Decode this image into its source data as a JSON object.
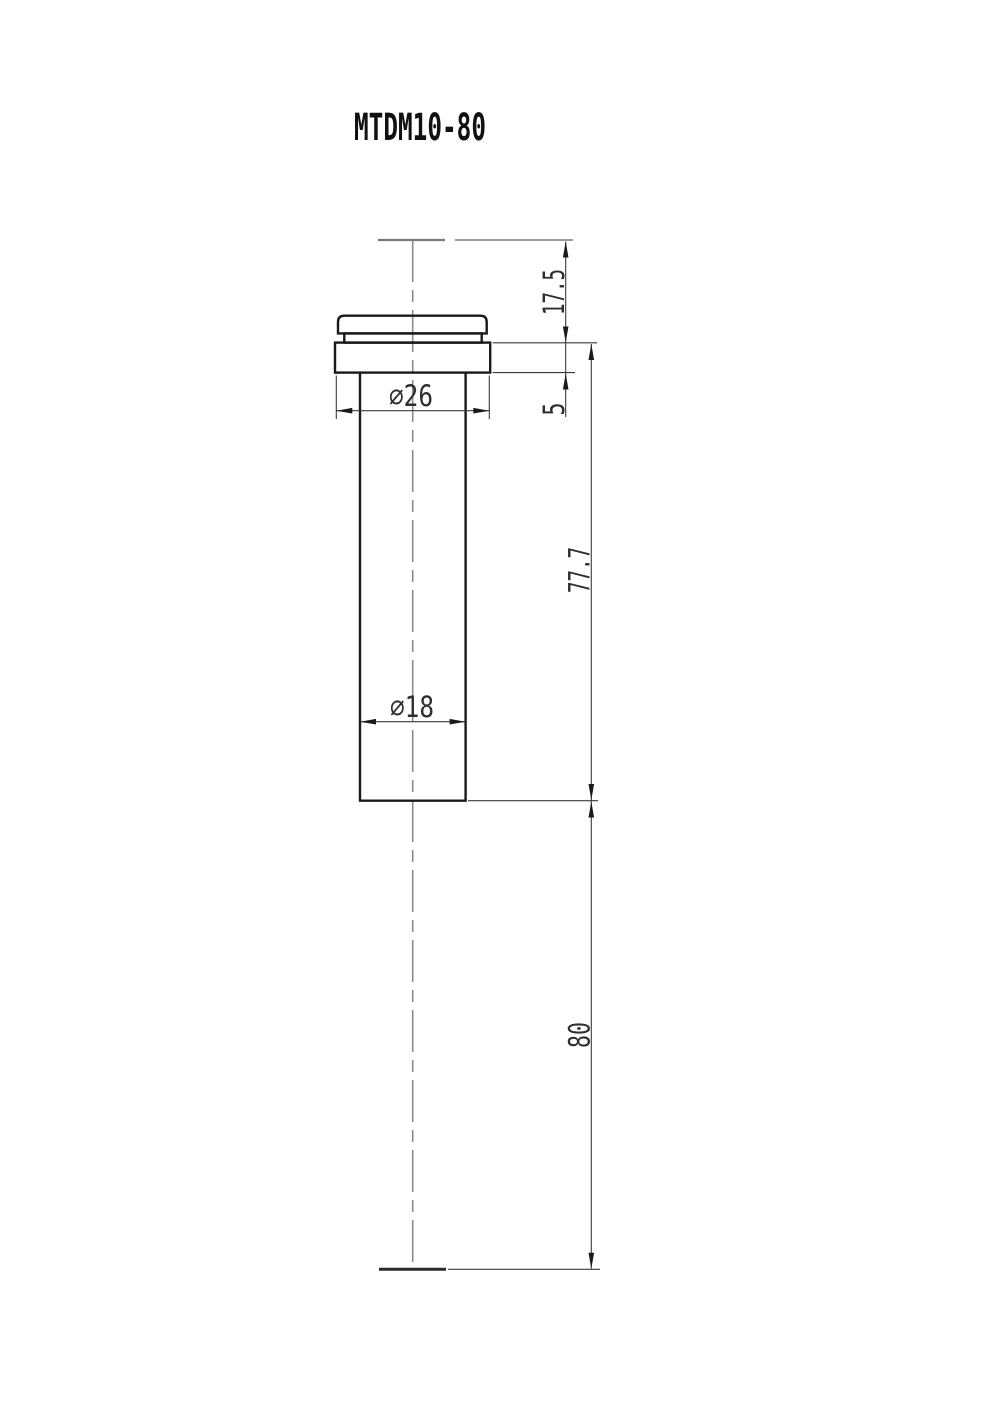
{
  "drawing": {
    "title": "MTDM10-80",
    "labels": {
      "top_offset": "17.5",
      "flange_thickness": "5",
      "body_length": "77.7",
      "overall_travel": "80",
      "flange_diameter": "⌀26",
      "body_diameter": "⌀18"
    },
    "colors": {
      "background": "#ffffff",
      "part_outline": "#1a1a1a",
      "dimension_lines": "#3a3a3a",
      "centerline": "#8c8c8c",
      "text": "#2e2e2e"
    }
  }
}
